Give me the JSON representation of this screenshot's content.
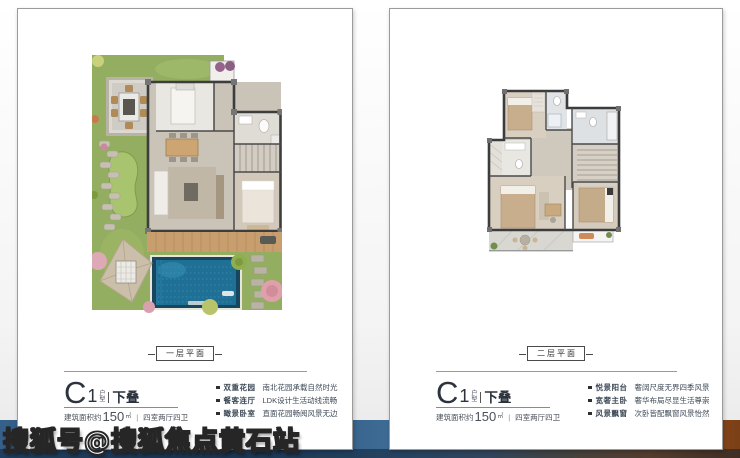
{
  "watermark": {
    "text": "搜狐号@搜狐焦点黄石站"
  },
  "panels": [
    {
      "level_label": "一层平面",
      "title": {
        "prefix": "C",
        "number": "1",
        "small_top": "户",
        "small_bottom": "型",
        "suffix": "下叠"
      },
      "area": {
        "label": "建筑面积约",
        "value": "150",
        "unit": "㎡",
        "separator": "|",
        "rooms": "四室两厅四卫"
      },
      "bullets": [
        {
          "title": "双重花园",
          "desc": "南北花园承载自然时光"
        },
        {
          "title": "餐客连厅",
          "desc": "LDK设计生活动线流畅"
        },
        {
          "title": "瞰景卧室",
          "desc": "直面花园畅阅风景无边"
        }
      ]
    },
    {
      "level_label": "二层平面",
      "title": {
        "prefix": "C",
        "number": "1",
        "small_top": "户",
        "small_bottom": "型",
        "suffix": "下叠"
      },
      "area": {
        "label": "建筑面积约",
        "value": "150",
        "unit": "㎡",
        "separator": "|",
        "rooms": "四室两厅四卫"
      },
      "bullets": [
        {
          "title": "悦景阳台",
          "desc": "奢阔尺度无界四季风景"
        },
        {
          "title": "宽奢主卧",
          "desc": "奢华布局尽显生活尊崇"
        },
        {
          "title": "风景飘窗",
          "desc": "次卧皆配飘窗风景怡然"
        }
      ]
    }
  ]
}
